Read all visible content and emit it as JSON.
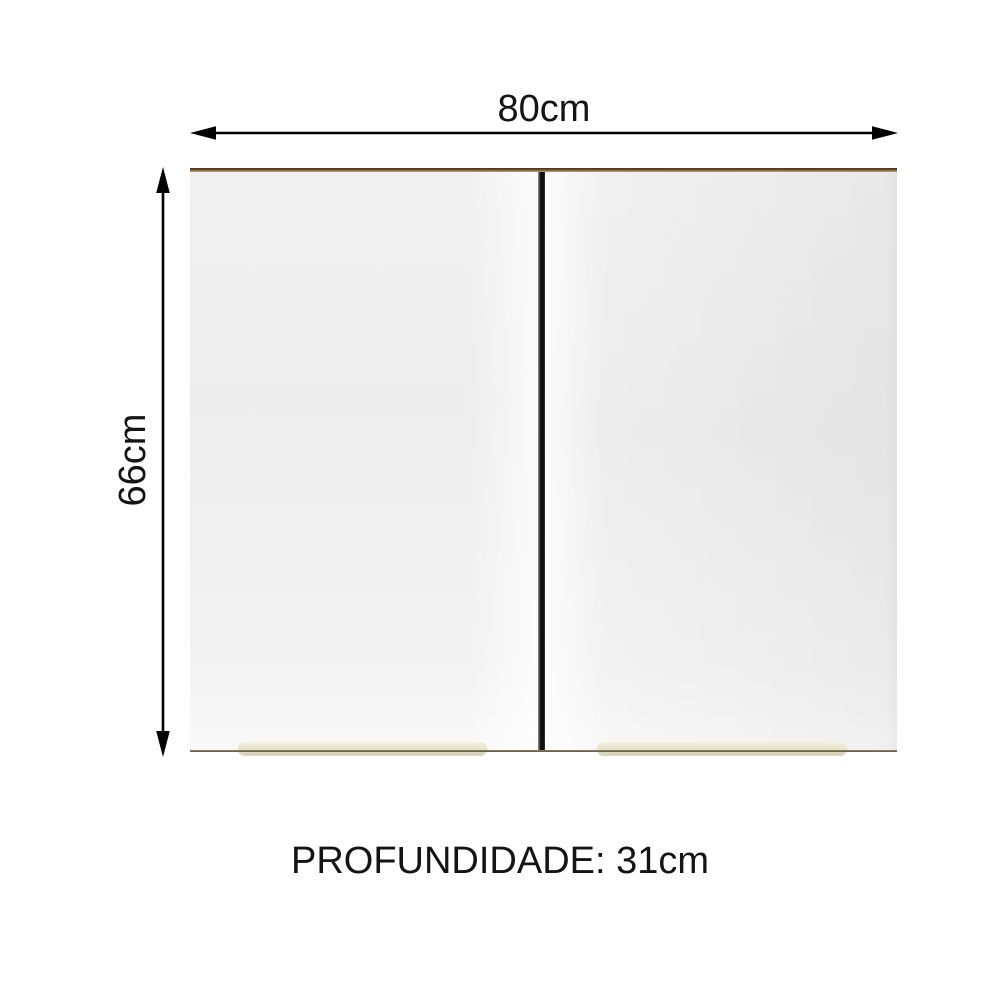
{
  "dimensions": {
    "width_label": "80cm",
    "height_label": "66cm",
    "depth_label": "PROFUNDIDADE: 31cm"
  },
  "colors": {
    "background": "#ffffff",
    "dimension_arrow": "#000000",
    "label_text": "#141414",
    "door_face": "#ededed",
    "cabinet_top_edge_wood": "#8a6b45",
    "cabinet_bottom_edge": "#6f6b4d",
    "door_gap_divider": "#141414",
    "handle_beige": "#e6e2ca"
  }
}
